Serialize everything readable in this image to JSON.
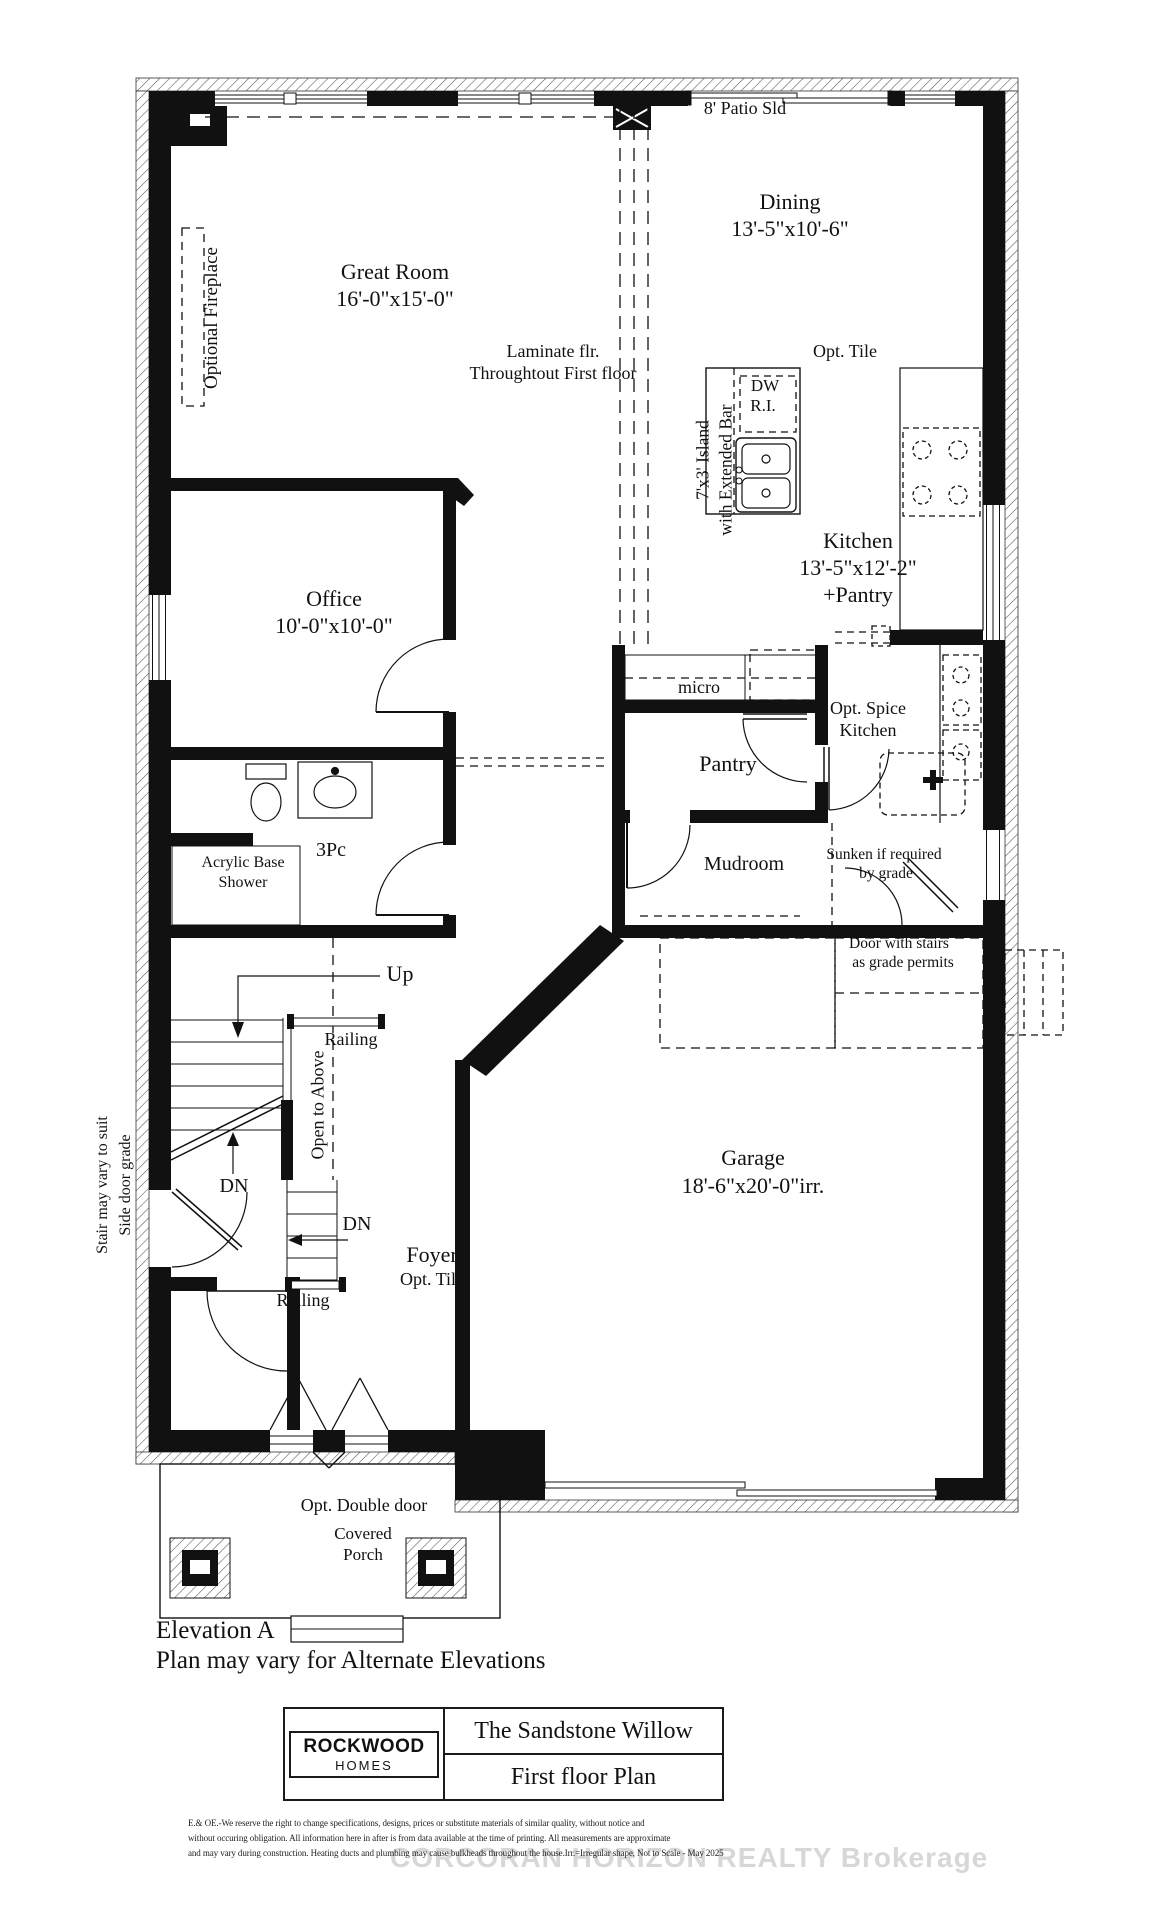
{
  "labels": {
    "patio_door": "8' Patio Sld",
    "dining": {
      "name": "Dining",
      "dims": "13'-5\"x10'-6\""
    },
    "great_room": {
      "name": "Great Room",
      "dims": "16'-0\"x15'-0\""
    },
    "optional_fireplace": "Optional Fireplace",
    "flooring_note": {
      "line1": "Laminate flr.",
      "line2": "Throughtout First floor"
    },
    "kitchen_floor_note": "Opt. Tile",
    "dishwasher": {
      "line1": "DW",
      "line2": "R.I."
    },
    "island": {
      "line1": "7'x3' Island",
      "line2": "with Extended Bar"
    },
    "kitchen": {
      "name": "Kitchen",
      "dims": "13'-5\"x12'-2\"",
      "extra": "+Pantry"
    },
    "office": {
      "name": "Office",
      "dims": "10'-0\"x10'-0\""
    },
    "microwave": "micro",
    "spice_kitchen": {
      "line1": "Opt. Spice",
      "line2": "Kitchen"
    },
    "pantry": "Pantry",
    "bath": "3Pc",
    "shower": {
      "line1": "Acrylic Base",
      "line2": "Shower"
    },
    "mudroom": "Mudroom",
    "sunken_note": {
      "line1": "Sunken if required",
      "line2": "by grade"
    },
    "grade_door_note": {
      "line1": "Door with stairs",
      "line2": "as grade permits"
    },
    "stairs": {
      "up": "Up",
      "dn_upper": "DN",
      "dn_lower": "DN",
      "railing_upper": "Railing",
      "railing_lower": "Railing",
      "open_to_above": "Open to Above",
      "side_note_line1": "Stair may vary to suit",
      "side_note_line2": "Side door grade"
    },
    "garage": {
      "name": "Garage",
      "dims": "18'-6\"x20'-0\"irr."
    },
    "foyer": {
      "name": "Foyer",
      "floor": "Opt. Tile"
    },
    "front_door_note": "Opt. Double door",
    "porch": {
      "line1": "Covered",
      "line2": "Porch"
    },
    "elevation": {
      "line1": "Elevation A",
      "line2": "Plan may vary for Alternate Elevations"
    }
  },
  "title_block": {
    "builder_line1": "ROCKWOOD",
    "builder_line2": "HOMES",
    "model_name": "The  Sandstone Willow",
    "sheet_name": "First floor Plan"
  },
  "disclaimer": {
    "line1": "E.& OE.-We reserve the right to change specifications, designs, prices or substitute materials of similar quality, without notice and",
    "line2": "without occuring obligation.  All information here in after is from data available at the time of printing. All measurements are approximate",
    "line3": "and may vary during construction. Heating ducts and plumbing may cause bulkheads throughout the house.Irr.=Irregular shape, Not to Scale - May 2025"
  },
  "watermark": "CORCORAN HORIZON REALTY Brokerage"
}
